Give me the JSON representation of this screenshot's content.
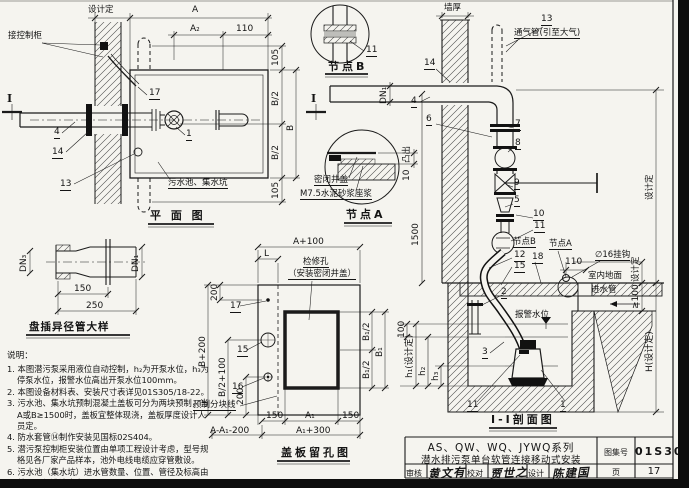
{
  "figures": {
    "plan": {
      "title": "平 面 图",
      "design_set": "设计定",
      "control_cabinet": "接控制柜",
      "sump": "污水池、集水坑",
      "section_mark": "I",
      "dims": {
        "a": "A",
        "a2": "A₂",
        "d110": "110",
        "d105_top": "105",
        "b2_top": "B/2",
        "b": "B",
        "b2_bottom": "B/2",
        "d105_bottom": "105"
      },
      "refs": {
        "r17": "17",
        "r1": "1",
        "r4": "4",
        "r14": "14",
        "r13": "13"
      }
    },
    "node_b": {
      "title": "节点B",
      "ref_11": "11"
    },
    "node_a": {
      "title": "节点A",
      "cover": "密闭井盖",
      "mortar": "M7.5水泥砂浆座浆",
      "protrude": "凸出",
      "d10": "10"
    },
    "section": {
      "title": "I-I剖面图",
      "wall_thickness": "墙厚",
      "vent": "通气管(引至大气)",
      "floor": "室内地面",
      "inlet": "进水管",
      "alarm": "报警水位",
      "hook": "∅16挂钩",
      "node_a_ref": "节点A",
      "node_b_ref": "节点B",
      "dims": {
        "dn1": "DN₁",
        "d1500": "1500",
        "d100": "100",
        "h1": "h₁(设计定)",
        "h2": "h₂",
        "h3": "h₃",
        "design_set": "设计定",
        "design_set2": "设计定",
        "H": "H(设计定)",
        "ge100": "≥100",
        "d110": "110"
      },
      "refs": {
        "r13": "13",
        "r14": "14",
        "r4": "4",
        "r6": "6",
        "r7": "7",
        "r8": "8",
        "r9": "9",
        "r5": "5",
        "r10": "10",
        "r11": "11",
        "r12": "12",
        "r18": "18",
        "r15": "15",
        "r2": "2",
        "r3": "3",
        "r11b": "11",
        "r1": "1"
      }
    },
    "reducer": {
      "title": "盘插异径管大样",
      "dn3": "DN₃",
      "dn1": "DN₁",
      "d150": "150",
      "d250": "250"
    },
    "cover": {
      "title": "盖板留孔图",
      "hole_line1": "检修孔",
      "hole_line2": "（安装密闭井盖）",
      "split_line": "预制分块线",
      "dims": {
        "a100": "A+100",
        "L": "L",
        "b200": "B+200",
        "d200_top": "200",
        "b2_100": "B/2+100",
        "d200_bottom": "200",
        "b1_2_top": "B₁/2",
        "b1_2_bottom": "B₁/2",
        "b1": "B₁",
        "d150_left": "150",
        "a1": "A₁",
        "d150_right": "150",
        "a_a1_200": "A-A₁-200",
        "a1_300": "A₁+300"
      },
      "refs": {
        "r17": "17",
        "r15": "15",
        "r16": "16"
      }
    }
  },
  "notes": {
    "heading": "说明：",
    "items": [
      "1. 本图潜污泵采用液位自动控制，h₂为开泵水位，h₃为停泵水位，报警水位高出开泵水位100mm。",
      "2. 本图设备材料表、安装尺寸表详见01S305/18-22。",
      "3. 污水池、集水坑预制混凝土盖板可分为两块预制，当A或B≥1500时，盖板宜整体现浇，盖板厚度设计人员定。",
      "4. 防水套管⑭制作安装见国标02S404。",
      "5. 潜污泵控制柜安装位置由单项工程设计考虑，型号规格见各厂家产品样本，池外电线电缆应穿管敷设。",
      "6. 污水池（集水坑）进水管数量、位置、管径及标高由单项工程设计确定。"
    ]
  },
  "titleblock": {
    "series": "AS、QW、WQ、JYWQ系列",
    "name": "潜水排污泵单台软管连接移动式安装",
    "atlas_label": "图集号",
    "atlas_no": "01S305",
    "page_label": "页",
    "page_no": "17",
    "audit_label": "审核",
    "audit_sig": "黄文有",
    "check_label": "校对",
    "check_sig": "贾世之",
    "design_label": "设计",
    "design_sig": "陈建国"
  }
}
